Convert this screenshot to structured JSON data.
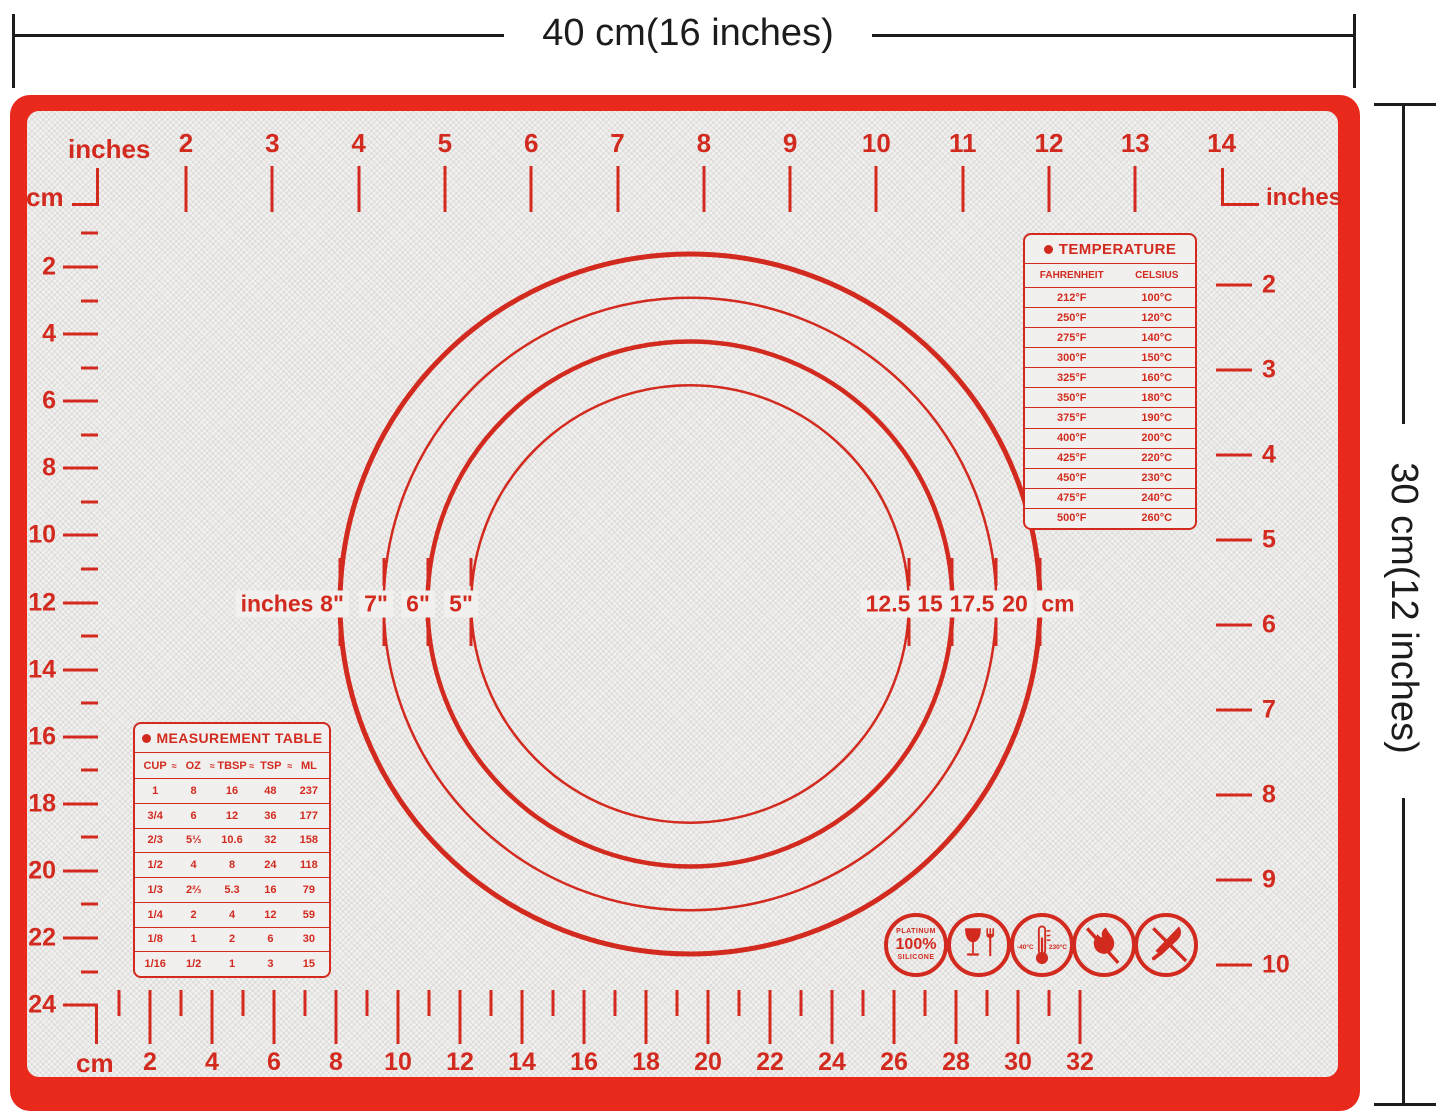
{
  "annotations": {
    "width_label": "40 cm(16 inches)",
    "height_label": "30 cm(12 inches)"
  },
  "colors": {
    "frame_red": "#e8291c",
    "print_red": "#d22a1f",
    "mat_surface": "#f1f0ee",
    "annotation_black": "#1c1c1c"
  },
  "rulers": {
    "top": {
      "unit_label": "inches",
      "corner_unit_label": "cm",
      "numbers": [
        "2",
        "3",
        "4",
        "5",
        "6",
        "7",
        "8",
        "9",
        "10",
        "11",
        "12",
        "13",
        "14"
      ]
    },
    "left": {
      "numbers": [
        "2",
        "4",
        "6",
        "8",
        "10",
        "12",
        "14",
        "16",
        "18",
        "20",
        "22",
        "24"
      ]
    },
    "right": {
      "unit_label": "inches",
      "numbers": [
        "2",
        "3",
        "4",
        "5",
        "6",
        "7",
        "8",
        "9",
        "10"
      ]
    },
    "bottom": {
      "unit_label": "cm",
      "numbers": [
        "2",
        "4",
        "6",
        "8",
        "10",
        "12",
        "14",
        "16",
        "18",
        "20",
        "22",
        "24",
        "26",
        "28",
        "30",
        "32"
      ]
    }
  },
  "circles": {
    "left_unit_label": "inches",
    "right_unit_label": "cm",
    "inch_labels": [
      "8\"",
      "7\"",
      "6\"",
      "5\""
    ],
    "cm_labels": [
      "12.5",
      "15",
      "17.5",
      "20"
    ],
    "diameters_cm": [
      20,
      17.5,
      15,
      12.5
    ]
  },
  "temperature_table": {
    "title": "TEMPERATURE",
    "headers": [
      "FAHRENHEIT",
      "CELSIUS"
    ],
    "rows": [
      [
        "212°F",
        "100°C"
      ],
      [
        "250°F",
        "120°C"
      ],
      [
        "275°F",
        "140°C"
      ],
      [
        "300°F",
        "150°C"
      ],
      [
        "325°F",
        "160°C"
      ],
      [
        "350°F",
        "180°C"
      ],
      [
        "375°F",
        "190°C"
      ],
      [
        "400°F",
        "200°C"
      ],
      [
        "425°F",
        "220°C"
      ],
      [
        "450°F",
        "230°C"
      ],
      [
        "475°F",
        "240°C"
      ],
      [
        "500°F",
        "260°C"
      ]
    ]
  },
  "measurement_table": {
    "title": "MEASUREMENT TABLE",
    "headers": [
      "CUP",
      "OZ",
      "TBSP",
      "TSP",
      "ML"
    ],
    "separator": "≈",
    "rows": [
      [
        "1",
        "8",
        "16",
        "48",
        "237"
      ],
      [
        "3/4",
        "6",
        "12",
        "36",
        "177"
      ],
      [
        "2/3",
        "5⅓",
        "10.6",
        "32",
        "158"
      ],
      [
        "1/2",
        "4",
        "8",
        "24",
        "118"
      ],
      [
        "1/3",
        "2⅔",
        "5.3",
        "16",
        "79"
      ],
      [
        "1/4",
        "2",
        "4",
        "12",
        "59"
      ],
      [
        "1/8",
        "1",
        "2",
        "6",
        "30"
      ],
      [
        "1/16",
        "1/2",
        "1",
        "3",
        "15"
      ]
    ]
  },
  "badges": {
    "platinum": {
      "top": "PLATINUM",
      "middle": "100%",
      "bottom": "SILICONE"
    },
    "temp_range": {
      "left": "-40°C",
      "right": "230°C"
    }
  }
}
